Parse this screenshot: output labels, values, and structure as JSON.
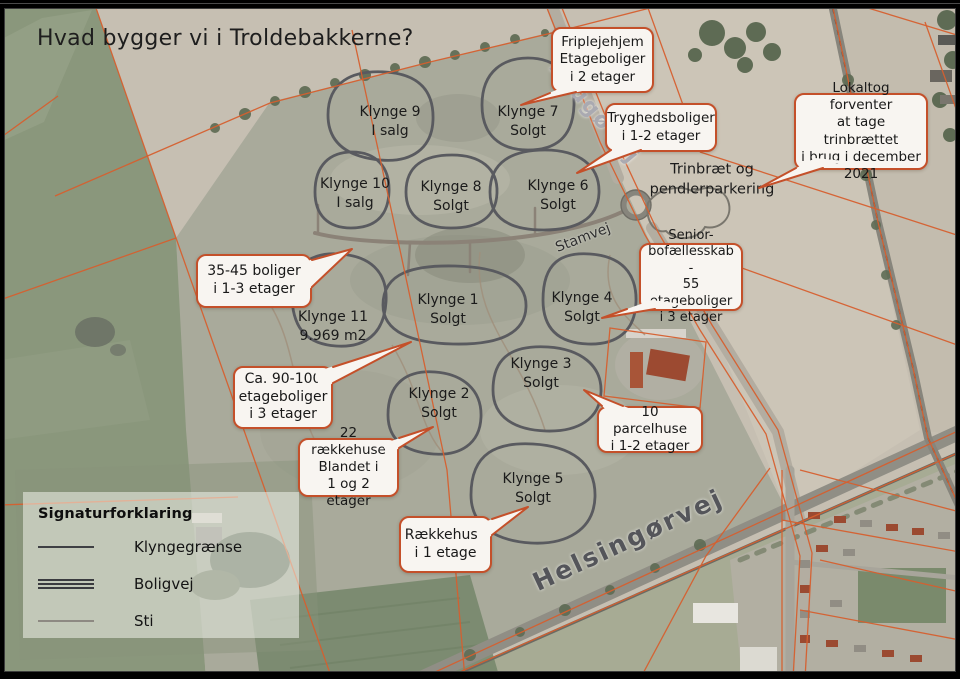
{
  "title": "Hvad bygger vi i Troldebakkerne?",
  "colors": {
    "accent_orange": "#c4502a",
    "callout_background": "#f8f5f1",
    "cluster_outline": "#595a5f",
    "parcel_line": "#d65f2e"
  },
  "callouts": [
    {
      "id": "friplejehjem",
      "text": "Friplejehjem\nEtageboliger\ni 2 etager"
    },
    {
      "id": "tryghedsboliger",
      "text": "Tryghedsboliger\ni 1-2 etager"
    },
    {
      "id": "lokaltog",
      "text": "Lokaltog forventer\nat tage trinbrættet\ni brug i december\n2021"
    },
    {
      "id": "seniorbofaellesskab",
      "text": "Senior-\nbofællesskab -\n55 etageboliger\ni 3 etager"
    },
    {
      "id": "boliger-35-45",
      "text": "35-45 boliger\ni 1-3 etager"
    },
    {
      "id": "etageboliger-90-100",
      "text": "Ca. 90-100\netageboliger\ni 3 etager"
    },
    {
      "id": "parcelhuse-10",
      "text": "10 parcelhuse\ni 1-2 etager"
    },
    {
      "id": "raekkehuse-22",
      "text": "22 rækkehuse\nBlandet i\n1 og 2 etager"
    },
    {
      "id": "raekkehuse-1-etage",
      "text": "Rækkehuse\ni 1 etage"
    }
  ],
  "clusters": [
    {
      "id": "klynge-9",
      "text": "Klynge 9\nI salg"
    },
    {
      "id": "klynge-7",
      "text": "Klynge 7\nSolgt"
    },
    {
      "id": "klynge-10",
      "text": "Klynge 10\nI salg"
    },
    {
      "id": "klynge-8",
      "text": "Klynge 8\nSolgt"
    },
    {
      "id": "klynge-6",
      "text": "Klynge 6\nSolgt"
    },
    {
      "id": "klynge-11",
      "text": "Klynge 11\n9.969 m2"
    },
    {
      "id": "klynge-1",
      "text": "Klynge 1\nSolgt"
    },
    {
      "id": "klynge-4",
      "text": "Klynge 4\nSolgt"
    },
    {
      "id": "klynge-2",
      "text": "Klynge 2\nSolgt"
    },
    {
      "id": "klynge-3",
      "text": "Klynge 3\nSolgt"
    },
    {
      "id": "klynge-5",
      "text": "Klynge 5\nSolgt"
    }
  ],
  "station_label": "Trinbræt og\npendlerparkering",
  "roads": [
    {
      "id": "laugovej",
      "name": "Laugøvej"
    },
    {
      "id": "stamvej",
      "name": "Stamvej"
    },
    {
      "id": "helsingorvej",
      "name": "Helsingørvej"
    }
  ],
  "legend": {
    "heading": "Signaturforklaring",
    "items": [
      {
        "id": "klyngegraense",
        "label": "Klyngegrænse"
      },
      {
        "id": "boligvej",
        "label": "Boligvej"
      },
      {
        "id": "sti",
        "label": "Sti"
      }
    ]
  }
}
